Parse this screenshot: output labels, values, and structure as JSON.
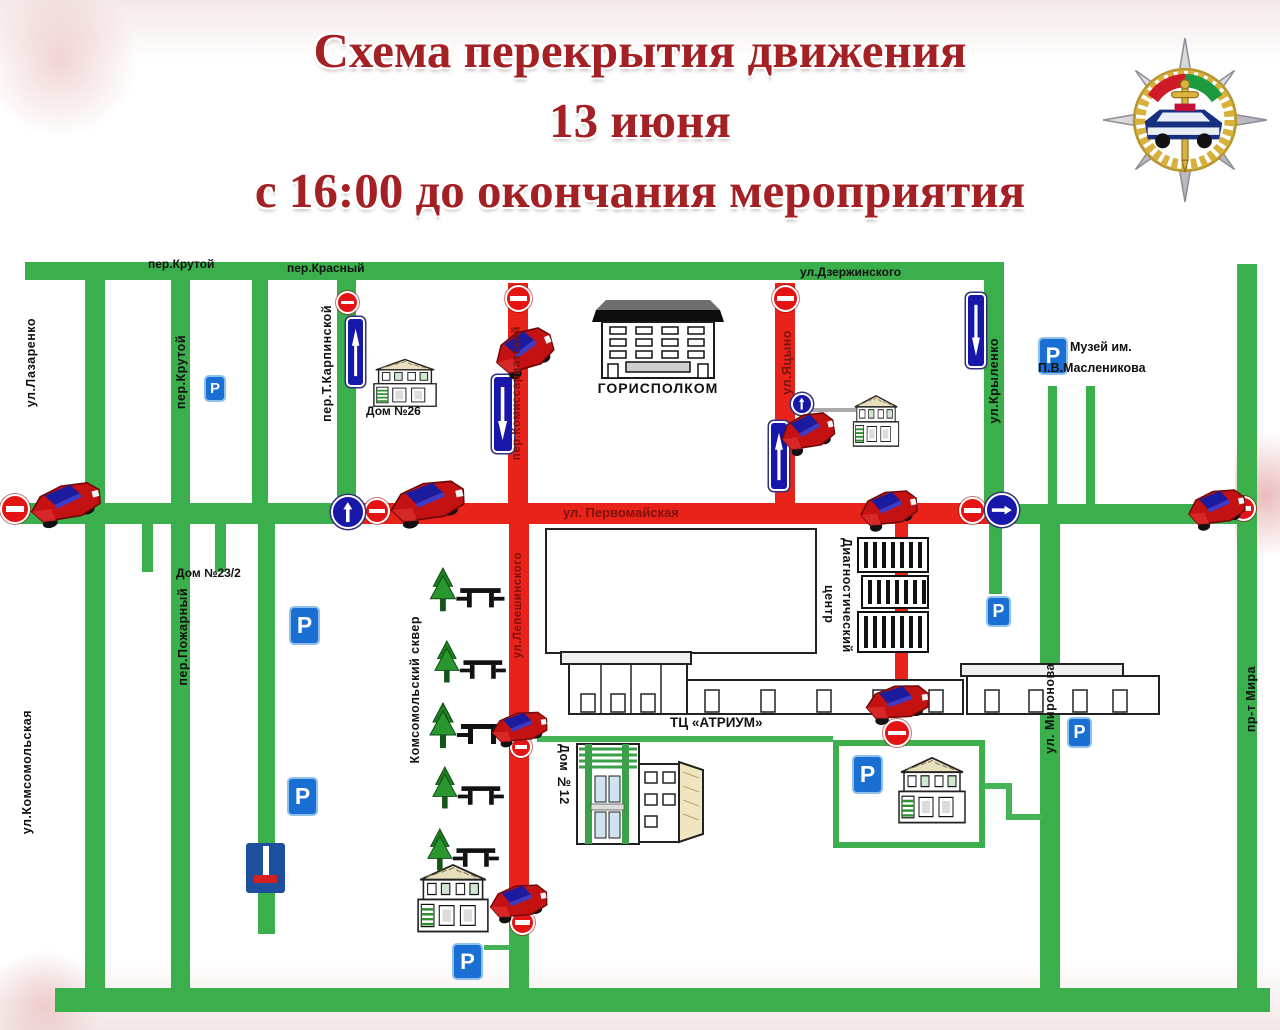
{
  "header": {
    "line1": "Схема перекрытия движения",
    "line2": "13 июня",
    "line3": "с 16:00 до окончания мероприятия"
  },
  "streets": {
    "per_krutoy_top": "пер.Крутой",
    "per_krasny": "пер.Красный",
    "dzerzhinskogo": "ул.Дзержинского",
    "lazarenko": "ул.Лазаренко",
    "per_krutoy_vert": "пер.Крутой",
    "per_t_karpinskoy": "пер.Т.Карпинской",
    "komissariatsky": "пер.Комиссариатский",
    "yatsyno": "ул.Яцыно",
    "krylenko": "ул.Крыленко",
    "pervomayskaya": "ул. Первомайская",
    "komsomolskaya": "ул.Комсомольская",
    "pozharny": "пер.Пожарный",
    "lepeshinskogo": "ул.Лепешинского",
    "mironova": "ул. Миронова",
    "mira": "пр-т Мира",
    "skver": "Комсомольский сквер"
  },
  "places": {
    "gorispolkom": "ГОРИСПОЛКОМ",
    "dom26": "Дом №26",
    "dom23": "Дом №23/2",
    "dom12": "Дом №12",
    "atrium": "ТЦ «АТРИУМ»",
    "diag_line1": "Диагностический",
    "diag_line2": "центр",
    "museum_line1": "Музей им.",
    "museum_line2": "П.В.Масленикова"
  },
  "signs": {
    "parking_letter": "P"
  },
  "colors": {
    "open_street": "#3aaf4b",
    "closed_street": "#e92319",
    "sign_blue": "#1718a9",
    "parking_blue": "#1a6fd4",
    "title_red": "#a32024"
  }
}
